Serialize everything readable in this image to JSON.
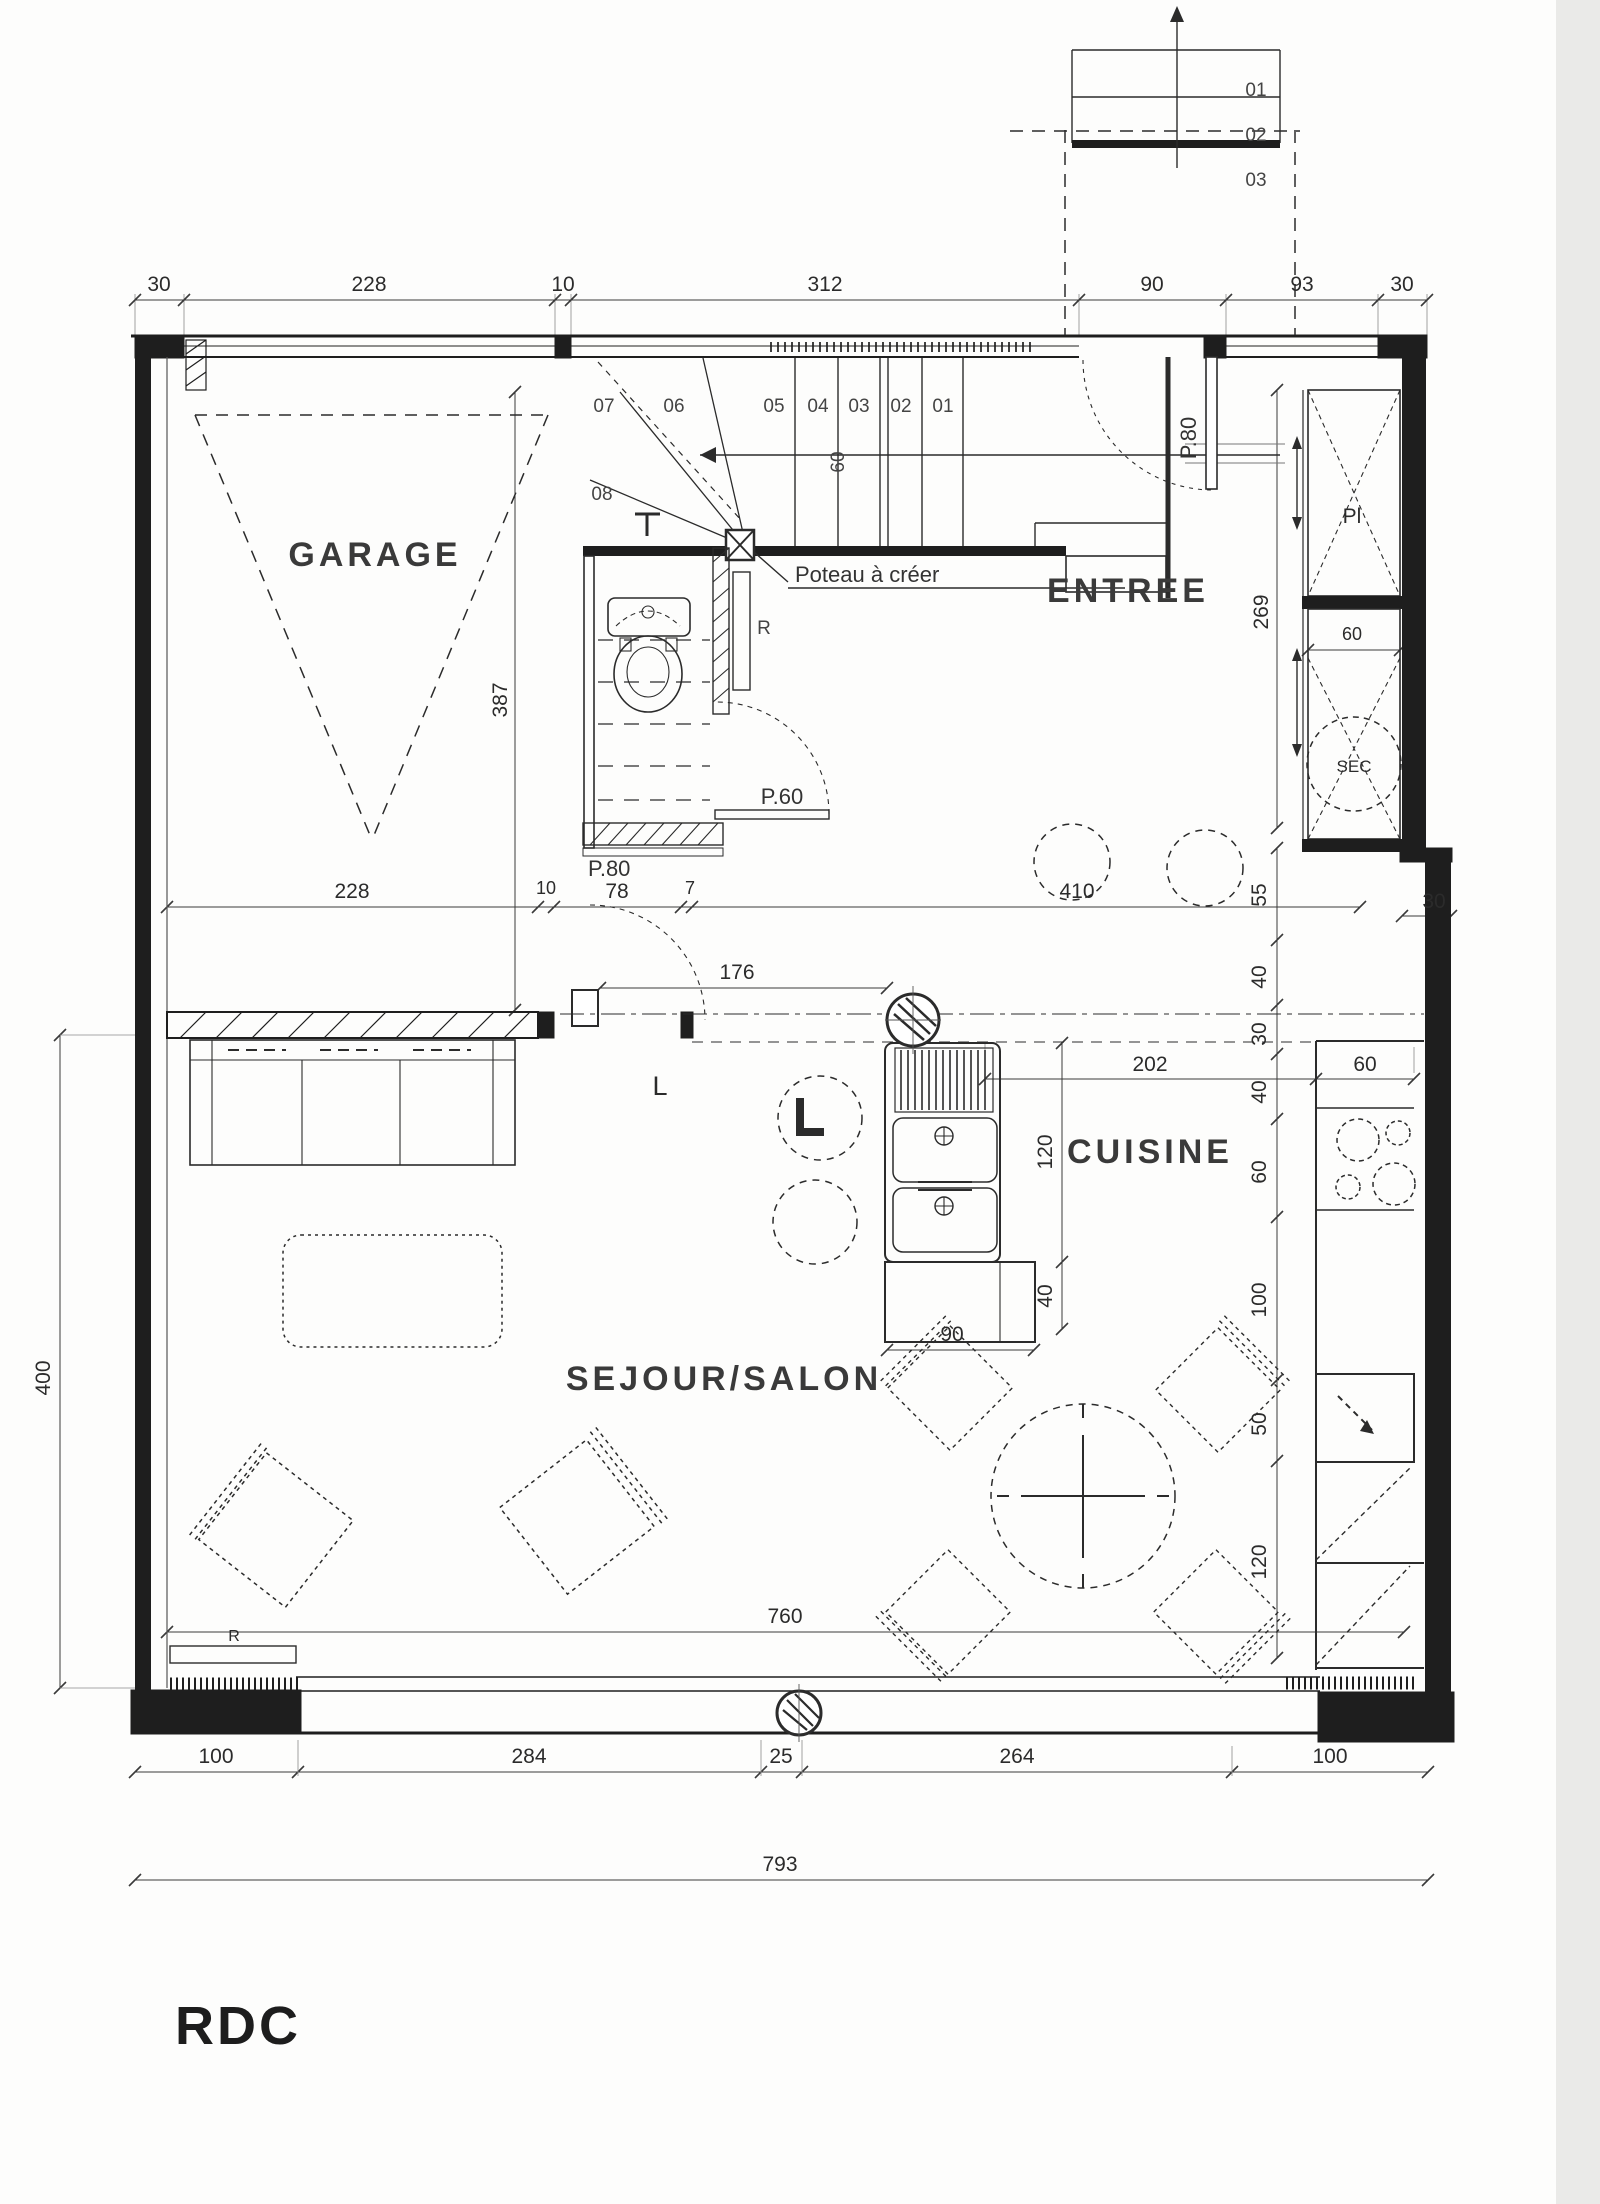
{
  "page": {
    "floor_label": "RDC"
  },
  "rooms": {
    "garage": "GARAGE",
    "entree": "ENTREE",
    "cuisine": "CUISINE",
    "sejour": "SEJOUR/SALON"
  },
  "annotations": {
    "poteau_note": "Poteau à créer",
    "wc_door": "P.60",
    "hall_door": "P.80",
    "entry_door": "P.80",
    "radiator_wc": "R",
    "radiator_sejour": "R",
    "appliance_l": "L",
    "closet_label": "Pl",
    "heater_label": "SEC",
    "stair_walk_width": "60"
  },
  "stairs": {
    "main": [
      "01",
      "02",
      "03",
      "04",
      "05",
      "06",
      "07",
      "08"
    ],
    "upper": [
      "01",
      "02",
      "03"
    ]
  },
  "dimensions": {
    "top": [
      "30",
      "228",
      "10",
      "312",
      "90",
      "93",
      "30"
    ],
    "mid": [
      "228",
      "10",
      "78",
      "7",
      "410"
    ],
    "hall_opening": "176",
    "sejour_height": "400",
    "garage_depth": "387",
    "entree_depth": "269",
    "right_chain": [
      "55",
      "40",
      "30",
      "40",
      "60",
      "100",
      "50",
      "120"
    ],
    "right_wall": "30",
    "kitchen_run": "202",
    "counter_depth": "60",
    "island_length": "120",
    "island_return": "40",
    "island_width": "90",
    "sejour_width": "760",
    "bottom": [
      "100",
      "284",
      "25",
      "264",
      "100"
    ],
    "overall_width": "793",
    "closet_width": "60"
  }
}
